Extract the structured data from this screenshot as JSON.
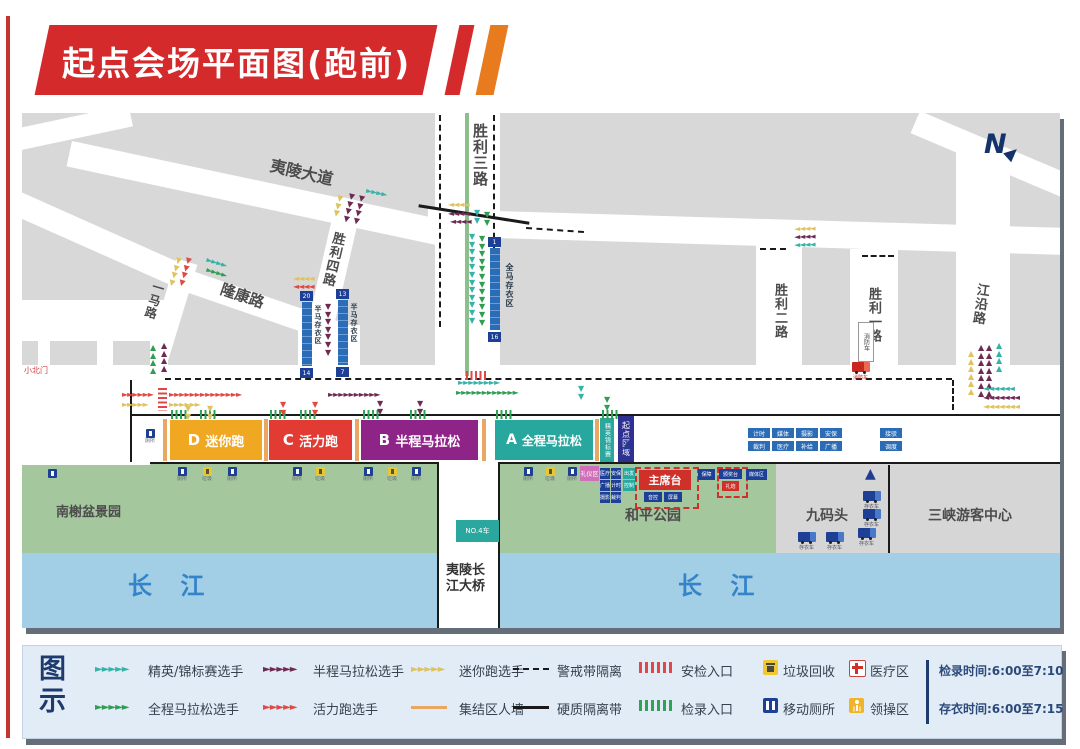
{
  "title": "起点会场平面图(跑前)",
  "compass": "N",
  "roads": {
    "yiling": "夷陵大道",
    "shengli3": "胜利三路",
    "shengli4": "胜利四路",
    "longkang": "隆康路",
    "yima": "一马路",
    "shengli2": "胜利二路",
    "shengli1": "胜利一路",
    "jiangyan": "江沿路",
    "xiaobeimen": "小北门"
  },
  "areas": {
    "park": "和平公园",
    "garden": "南榭盆景园",
    "wharf": "九码头",
    "visitor_center": "三峡游客中心",
    "river_left": "长 江",
    "river_right": "长 江",
    "bridge_line1": "夷陵长",
    "bridge_line2": "江大桥",
    "bridge_tag": "NO.4车"
  },
  "corrals": {
    "d_letter": "D",
    "d_name": "迷你跑",
    "d_color": "#f0a722",
    "c_letter": "C",
    "c_name": "活力跑",
    "c_color": "#e23b33",
    "b_letter": "B",
    "b_name": "半程马拉松",
    "b_color": "#8f2488",
    "a_letter": "A",
    "a_name": "全程马拉松",
    "a_color": "#28a79e",
    "elite": "精英锦标赛",
    "start": "起点区域"
  },
  "storage": {
    "full_label": "全马存衣区",
    "full_top": "1",
    "full_bottom": "16",
    "half_label1": "半马存衣区",
    "half1_top": "20",
    "half1_bottom": "14",
    "half_label2": "半马存衣区",
    "half2_top": "13",
    "half2_bottom": "7"
  },
  "stage": {
    "main": "主席台",
    "sub1": "音控",
    "sub2": "屏幕",
    "right1": "保障",
    "right2": "颁奖台",
    "right3": "礼炮",
    "right4": "媒体区",
    "pink": "礼仪区",
    "grid": [
      "医疗",
      "安保",
      "广播",
      "计时",
      "摄影",
      "裁判"
    ],
    "teal": [
      "出发",
      "控制"
    ]
  },
  "road_boxes": {
    "row1": [
      "计时",
      "媒体",
      "摄影",
      "安保"
    ],
    "row2": [
      "裁判",
      "医疗",
      "补给",
      "广播"
    ],
    "pair": [
      "接驳",
      "调度"
    ]
  },
  "fire": {
    "sign": "消防车",
    "caption": "消防车"
  },
  "trucks": {
    "caption": "存衣车"
  },
  "mini": {
    "toilet": "厕所",
    "trash": "垃圾"
  },
  "colors": {
    "banner_red": "#d42a2c",
    "banner_orange": "#e87b1e",
    "park_green": "#a4c79e",
    "river_blue": "#a2cfe6",
    "elite_teal": "#35b3a8",
    "full_green": "#2f9e53",
    "half_maroon": "#6e2a52",
    "fun_red": "#e04a42",
    "mini_yellow": "#dfc35f",
    "wall_orange": "#eaa763"
  },
  "legend": {
    "title": "图示",
    "runners": [
      {
        "label": "精英/锦标赛选手",
        "color": "#35b3a8"
      },
      {
        "label": "半程马拉松选手",
        "color": "#6e2a52"
      },
      {
        "label": "迷你跑选手",
        "color": "#dfc35f"
      },
      {
        "label": "全程马拉松选手",
        "color": "#2f9e53"
      },
      {
        "label": "活力跑选手",
        "color": "#e04a42"
      }
    ],
    "lines": [
      {
        "label": "警戒带隔离"
      },
      {
        "label": "硬质隔离带"
      },
      {
        "label": "集结区人墙",
        "color": "#eaa763"
      }
    ],
    "entrances": [
      {
        "label": "安检入口",
        "color": "#e04848"
      },
      {
        "label": "检录入口",
        "color": "#2fa353"
      }
    ],
    "facilities": [
      {
        "label": "垃圾回收"
      },
      {
        "label": "移动厕所"
      },
      {
        "label": "医疗区"
      },
      {
        "label": "领操区"
      }
    ],
    "times": [
      "检录时间:6:00至7:10",
      "存衣时间:6:00至7:15"
    ]
  }
}
